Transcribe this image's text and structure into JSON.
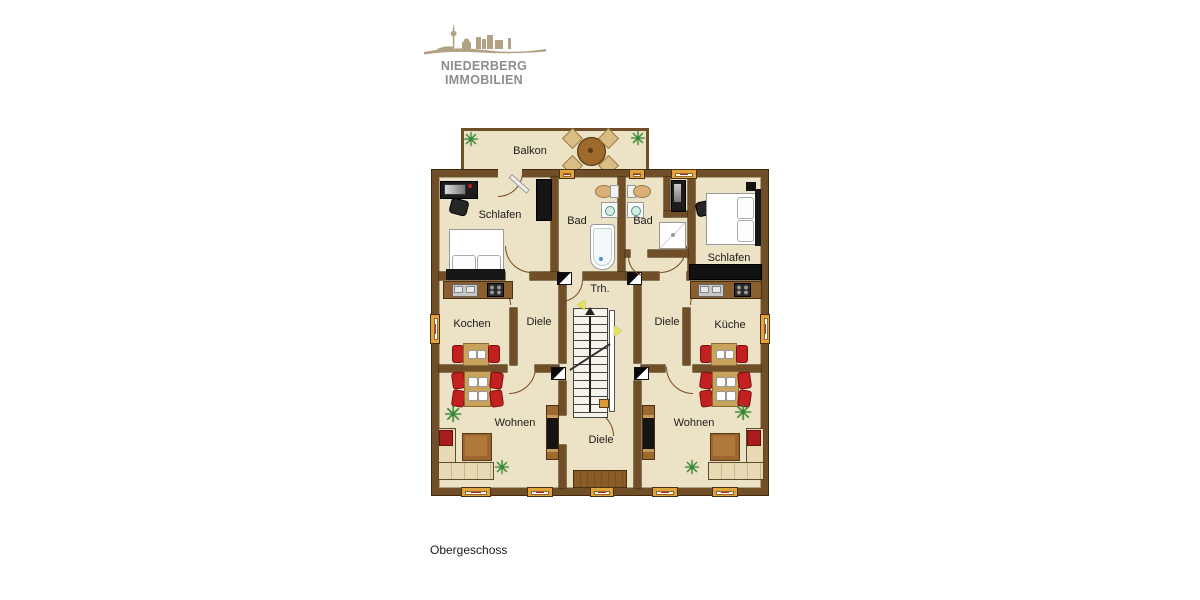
{
  "brand": {
    "logo_text": "NIEDERBERG IMMOBILIEN"
  },
  "floor_label": "Obergeschoss",
  "rooms": {
    "balkon": "Balkon",
    "schlafen_left": "Schlafen",
    "bad_left": "Bad",
    "bad_right": "Bad",
    "schlafen_right": "Schlafen",
    "treppenhaus": "Trh.",
    "kochen": "Kochen",
    "diele_left": "Diele",
    "diele_right": "Diele",
    "kueche": "Küche",
    "wohnen_left": "Wohnen",
    "wohnen_right": "Wohnen",
    "diele_center": "Diele"
  },
  "icons": {
    "plant_glyph": "✳"
  },
  "colors": {
    "wall_brown": "#6f4e28",
    "floor_beige": "#ece3c6",
    "window_gold": "#e2a33c",
    "chair_red": "#c32020",
    "table_tan": "#c8a35c",
    "plant_green": "#2e8b2e",
    "logo_tan": "#b3a183",
    "logo_text_gray": "#8d8d8d"
  }
}
